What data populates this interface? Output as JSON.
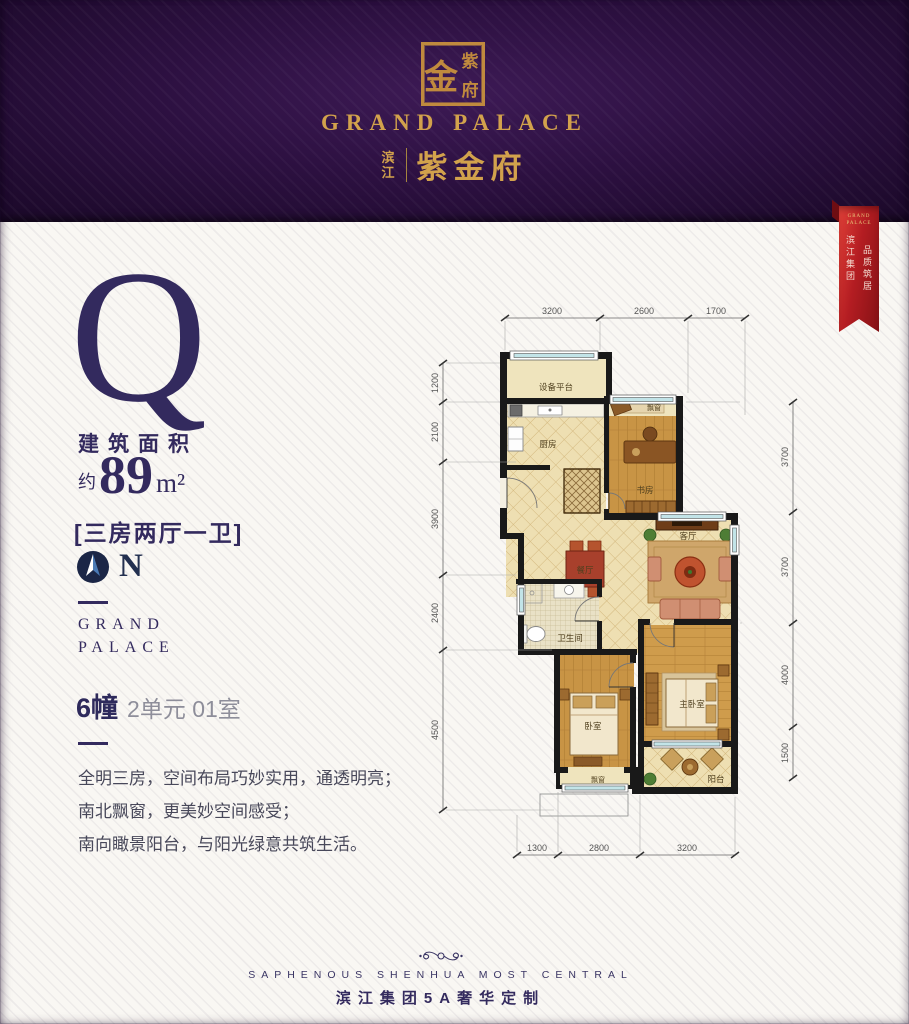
{
  "header": {
    "seal_char_main": "金",
    "seal_char_top": "紫",
    "seal_char_bottom": "府",
    "brand_en": "GRAND PALACE",
    "brand_cn_prefix_1": "滨",
    "brand_cn_prefix_2": "江",
    "brand_cn_name": "紫金府"
  },
  "ribbon": {
    "brand_line1": "GRAND",
    "brand_line2": "PALACE",
    "col_left": "滨江集团",
    "col_right": "品质筑居"
  },
  "panel": {
    "plan_letter": "Q",
    "area_label": "建筑面积",
    "area_approx": "约",
    "area_value": "89",
    "area_unit": "m²",
    "layout_text": "[三房两厅一卫]",
    "north_label": "N",
    "brand_line1": "GRAND",
    "brand_line2": "PALACE",
    "unit_building": "6幢",
    "unit_detail": "2单元 01室",
    "desc_line1": "全明三房，空间布局巧妙实用，通透明亮；",
    "desc_line2": "南北飘窗，更美妙空间感受；",
    "desc_line3": "南向瞰景阳台，与阳光绿意共筑生活。"
  },
  "floorplan": {
    "rooms": [
      {
        "label": "设备平台"
      },
      {
        "label": "厨房"
      },
      {
        "label": "飘窗"
      },
      {
        "label": "书房"
      },
      {
        "label": "餐厅"
      },
      {
        "label": "客厅"
      },
      {
        "label": "卫生间"
      },
      {
        "label": "卧室"
      },
      {
        "label": "主卧室"
      },
      {
        "label": "飘窗"
      },
      {
        "label": "阳台"
      }
    ],
    "dims_top": [
      "3200",
      "2600",
      "1700"
    ],
    "dims_left": [
      "1200",
      "2100",
      "3900",
      "2400",
      "4500"
    ],
    "dims_right": [
      "3700",
      "3700",
      "4000",
      "1500"
    ],
    "dims_bottom": [
      "1300",
      "2800",
      "3200"
    ]
  },
  "footer": {
    "tagline_en": "SAPHENOUS SHENHUA MOST CENTRAL",
    "tagline_cn": "滨江集团5A奢华定制"
  },
  "colors": {
    "gold": "#d2a24c",
    "purple_bg": "#2c1040",
    "indigo": "#332a5e",
    "ribbon_red": "#b41d22"
  }
}
